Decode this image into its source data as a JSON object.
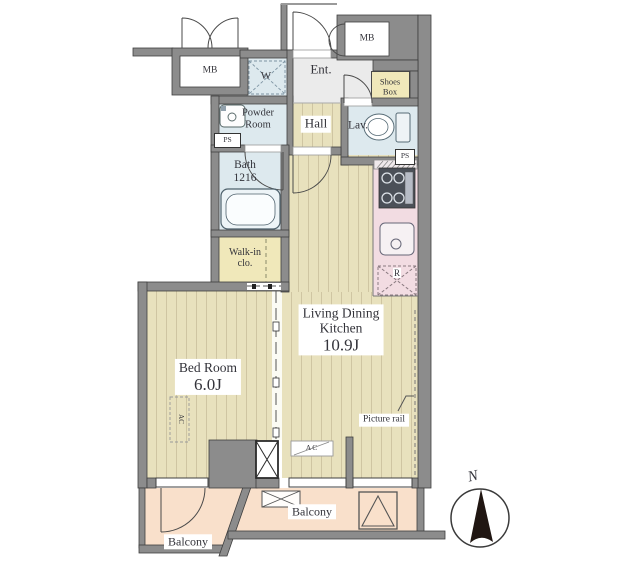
{
  "rooms": {
    "ldk": {
      "line1": "Living Dining",
      "line2": "Kitchen",
      "size": "10.9J"
    },
    "bedroom": {
      "name": "Bed Room",
      "size": "6.0J"
    },
    "hall": "Hall",
    "entrance": "Ent.",
    "lavatory": "Lav.",
    "bath": {
      "line1": "Bath",
      "line2": "1216"
    },
    "powder": {
      "line1": "Powder",
      "line2": "Room"
    },
    "walkin": {
      "line1": "Walk-in",
      "line2": "clo."
    },
    "shoes": {
      "line1": "Shoes",
      "line2": "Box"
    },
    "w_closet": "W",
    "balcony_left": "Balcony",
    "balcony_right": "Balcony"
  },
  "markers": {
    "mb_left": "MB",
    "mb_right": "MB",
    "ps_left": "PS",
    "ps_right": "PS",
    "refrigerator": "R",
    "ac_living": "AC",
    "ac_bedroom": "AC",
    "picture_rail": "Picture rail",
    "north": "N"
  },
  "colors": {
    "wall": "#8c8c8c",
    "wood_floor": "#e8e1bd",
    "wood_stripe": "#cfc5a2",
    "wet_area": "#dde9ee",
    "closet": "#f0e8ba",
    "kitchen_counter": "#f2dce2",
    "balcony": "#f9e0cb",
    "entrance_floor": "#ebebeb",
    "compass_needle": "#201612",
    "label_text": "#33333a"
  }
}
